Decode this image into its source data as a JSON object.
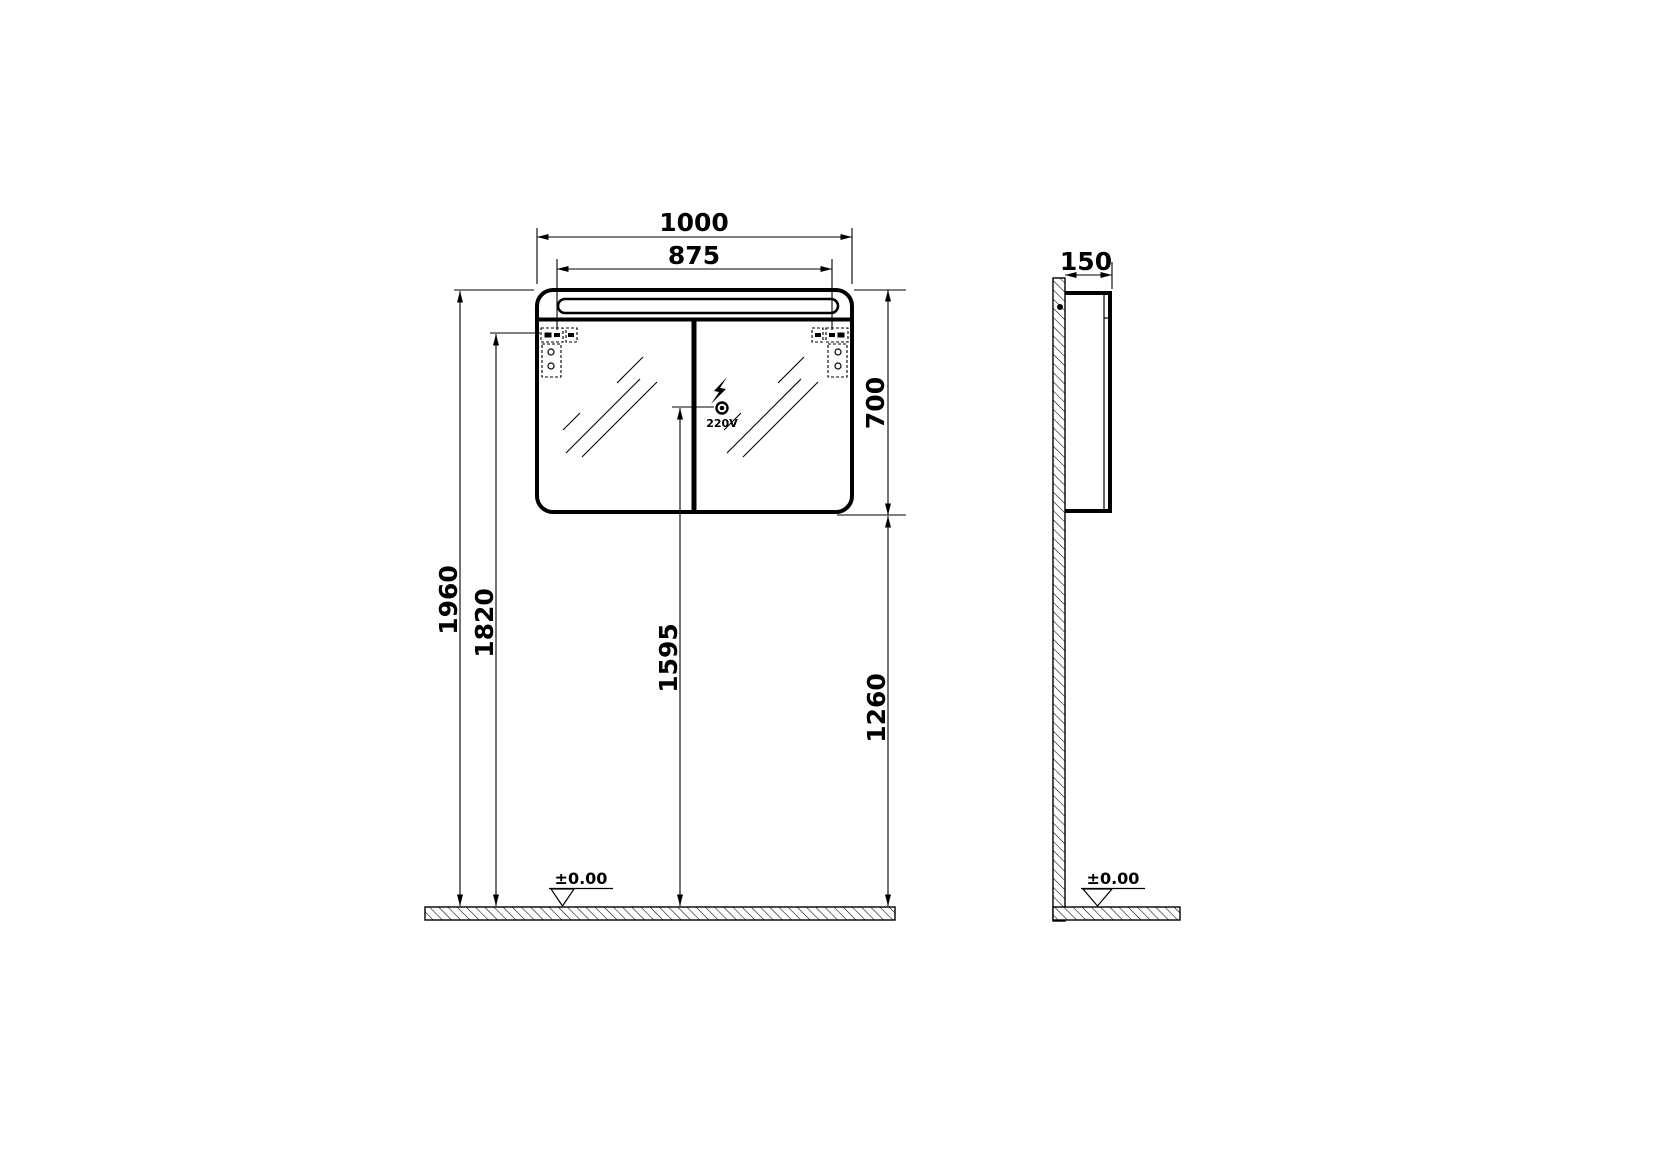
{
  "colors": {
    "line": "#000000",
    "background": "#ffffff"
  },
  "front_view": {
    "dim_overall_width": "1000",
    "dim_hinge_spacing": "875",
    "dim_cabinet_height": "700",
    "dim_top_height": "1960",
    "dim_hinge_height": "1820",
    "dim_socket_height": "1595",
    "dim_cabinet_bottom_height": "1260",
    "socket_label": "220V",
    "floor_level": "±0.00"
  },
  "side_view": {
    "dim_depth": "150",
    "floor_level": "±0.00"
  }
}
